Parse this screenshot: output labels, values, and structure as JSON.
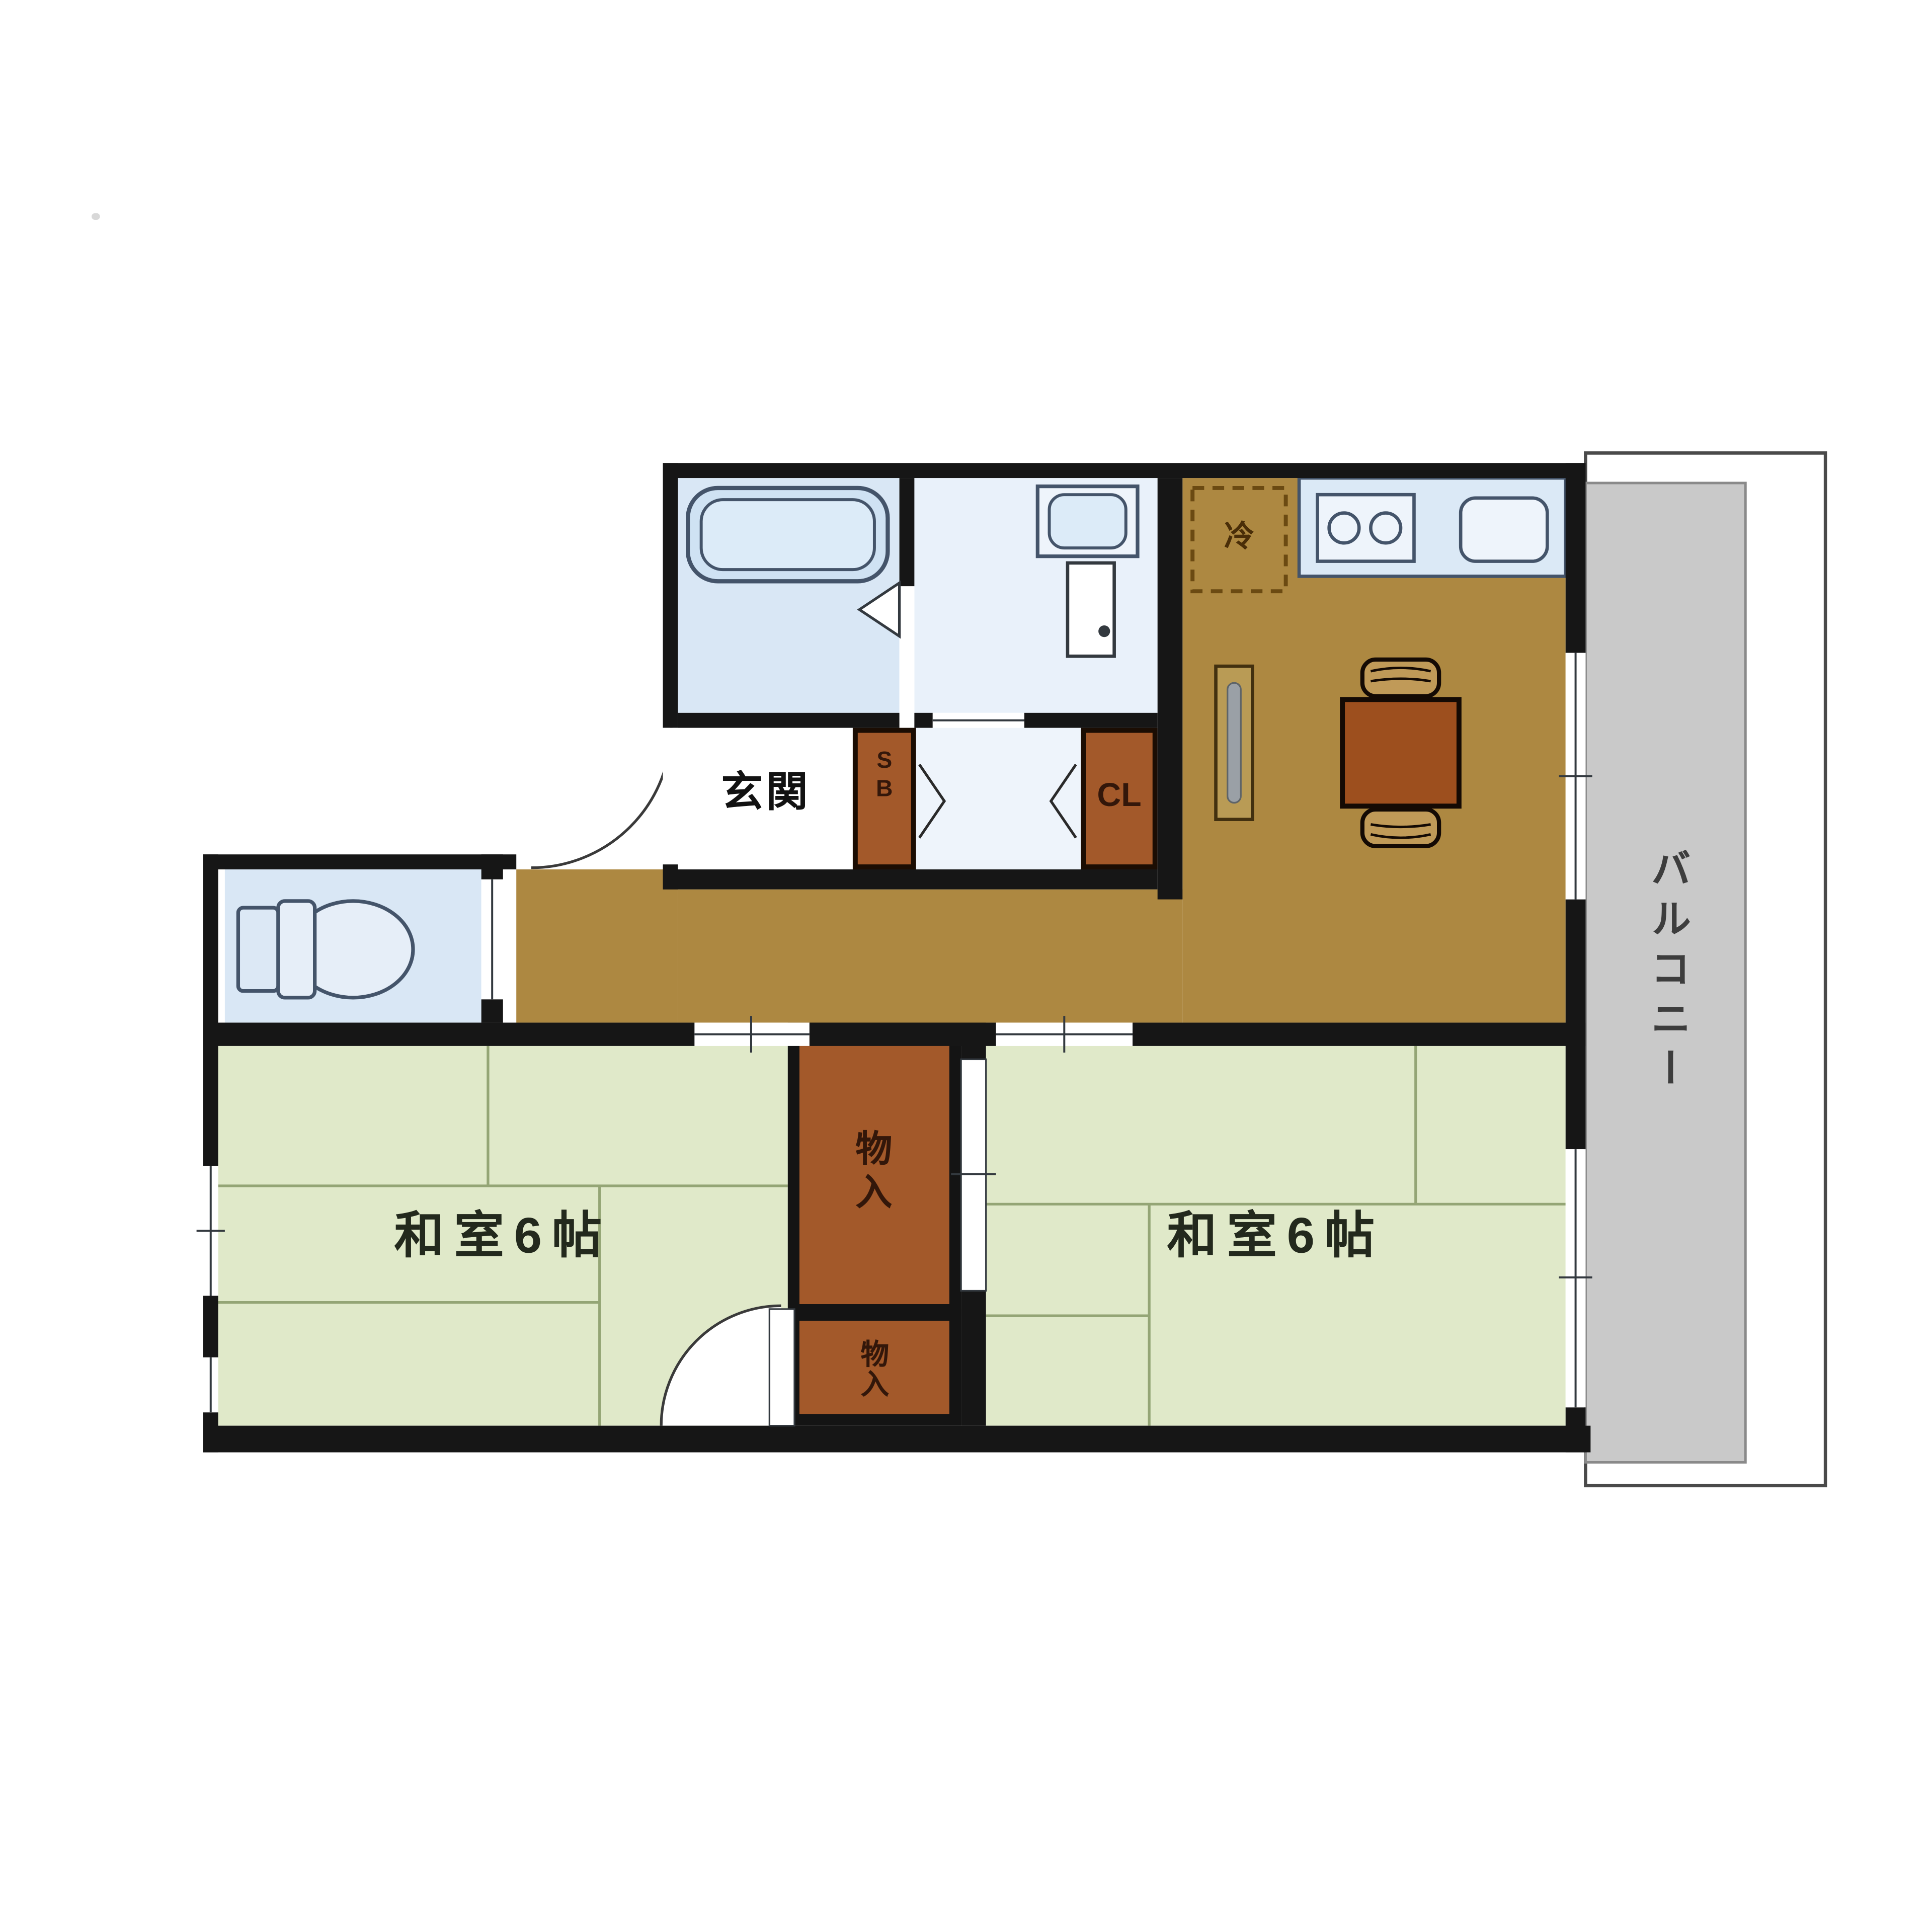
{
  "floor_plan": {
    "type": "japanese-apartment-2dk-floor-plan",
    "labels": {
      "genkan": "玄関",
      "shoe_box": "S\nB",
      "closet": "CL",
      "refrigerator": "冷",
      "storage_upper": "物入",
      "storage_lower": "物入",
      "washitsu_left": "和室6帖",
      "washitsu_right": "和室6帖",
      "balcony": "バルコニー"
    },
    "colors": {
      "wall": "#161616",
      "flooring_brown": "#ad8841",
      "storage_brown": "#a3592a",
      "tatami_green": "#e0e9c9",
      "tatami_line": "#94a575",
      "water_area_blue": "#d9e7f5",
      "washroom_blue": "#e9f1fa",
      "balcony_gray": "#c9c9c9",
      "fixture_outline": "#44546a",
      "table_brown": "#9d4f1e",
      "chair_tan": "#c09a58"
    }
  }
}
